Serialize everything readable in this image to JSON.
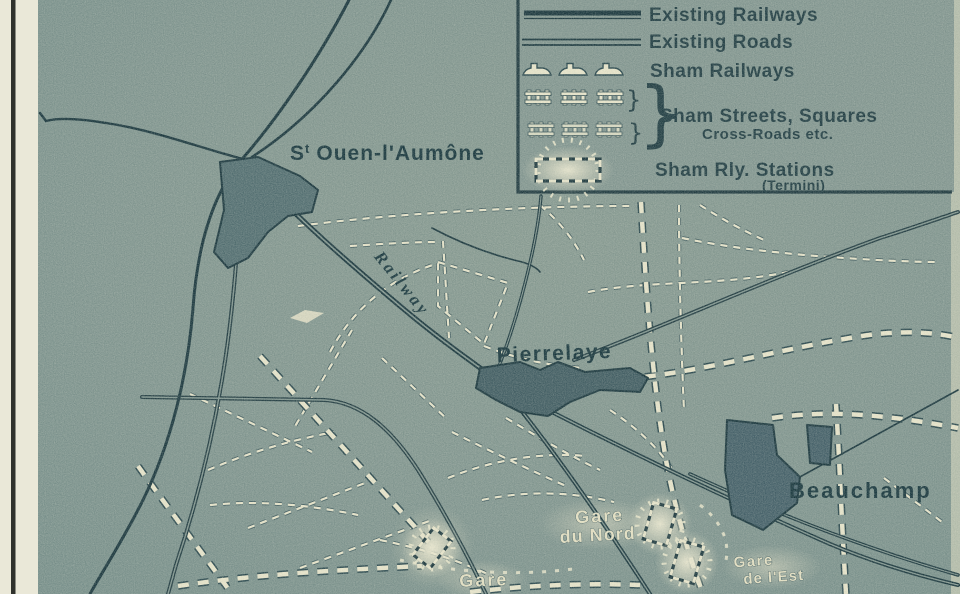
{
  "legend": {
    "existing_railways": "Existing Railways",
    "existing_roads": "Existing Roads",
    "sham_railways": "Sham Railways",
    "sham_streets_line1": "Sham Streets, Squares",
    "sham_streets_line2": "Cross-Roads etc.",
    "sham_stations_line1": "Sham Rly. Stations",
    "sham_stations_line2": "(Termini)",
    "brace_small": "}",
    "brace_big": "}"
  },
  "labels": {
    "st_ouen_prefix": "S",
    "st_ouen_sup": "t",
    "st_ouen_rest": "Ouen-l'Aumône",
    "railway": "Railway",
    "pierrelaye": "Pierrelaye",
    "beauchamp": "Beauchamp",
    "gare_du_nord_1": "Gare",
    "gare_du_nord_2": "du Nord",
    "gare_de_lest_1": "Gare",
    "gare_de_lest_2": "de l'Est",
    "gare_sw": "Gare"
  },
  "colors": {
    "paper": "#eae8d8",
    "map_background": "#7e938d",
    "ink": "#1b363c",
    "cream": "#e6e3c9",
    "town_fill": "#46626a"
  }
}
